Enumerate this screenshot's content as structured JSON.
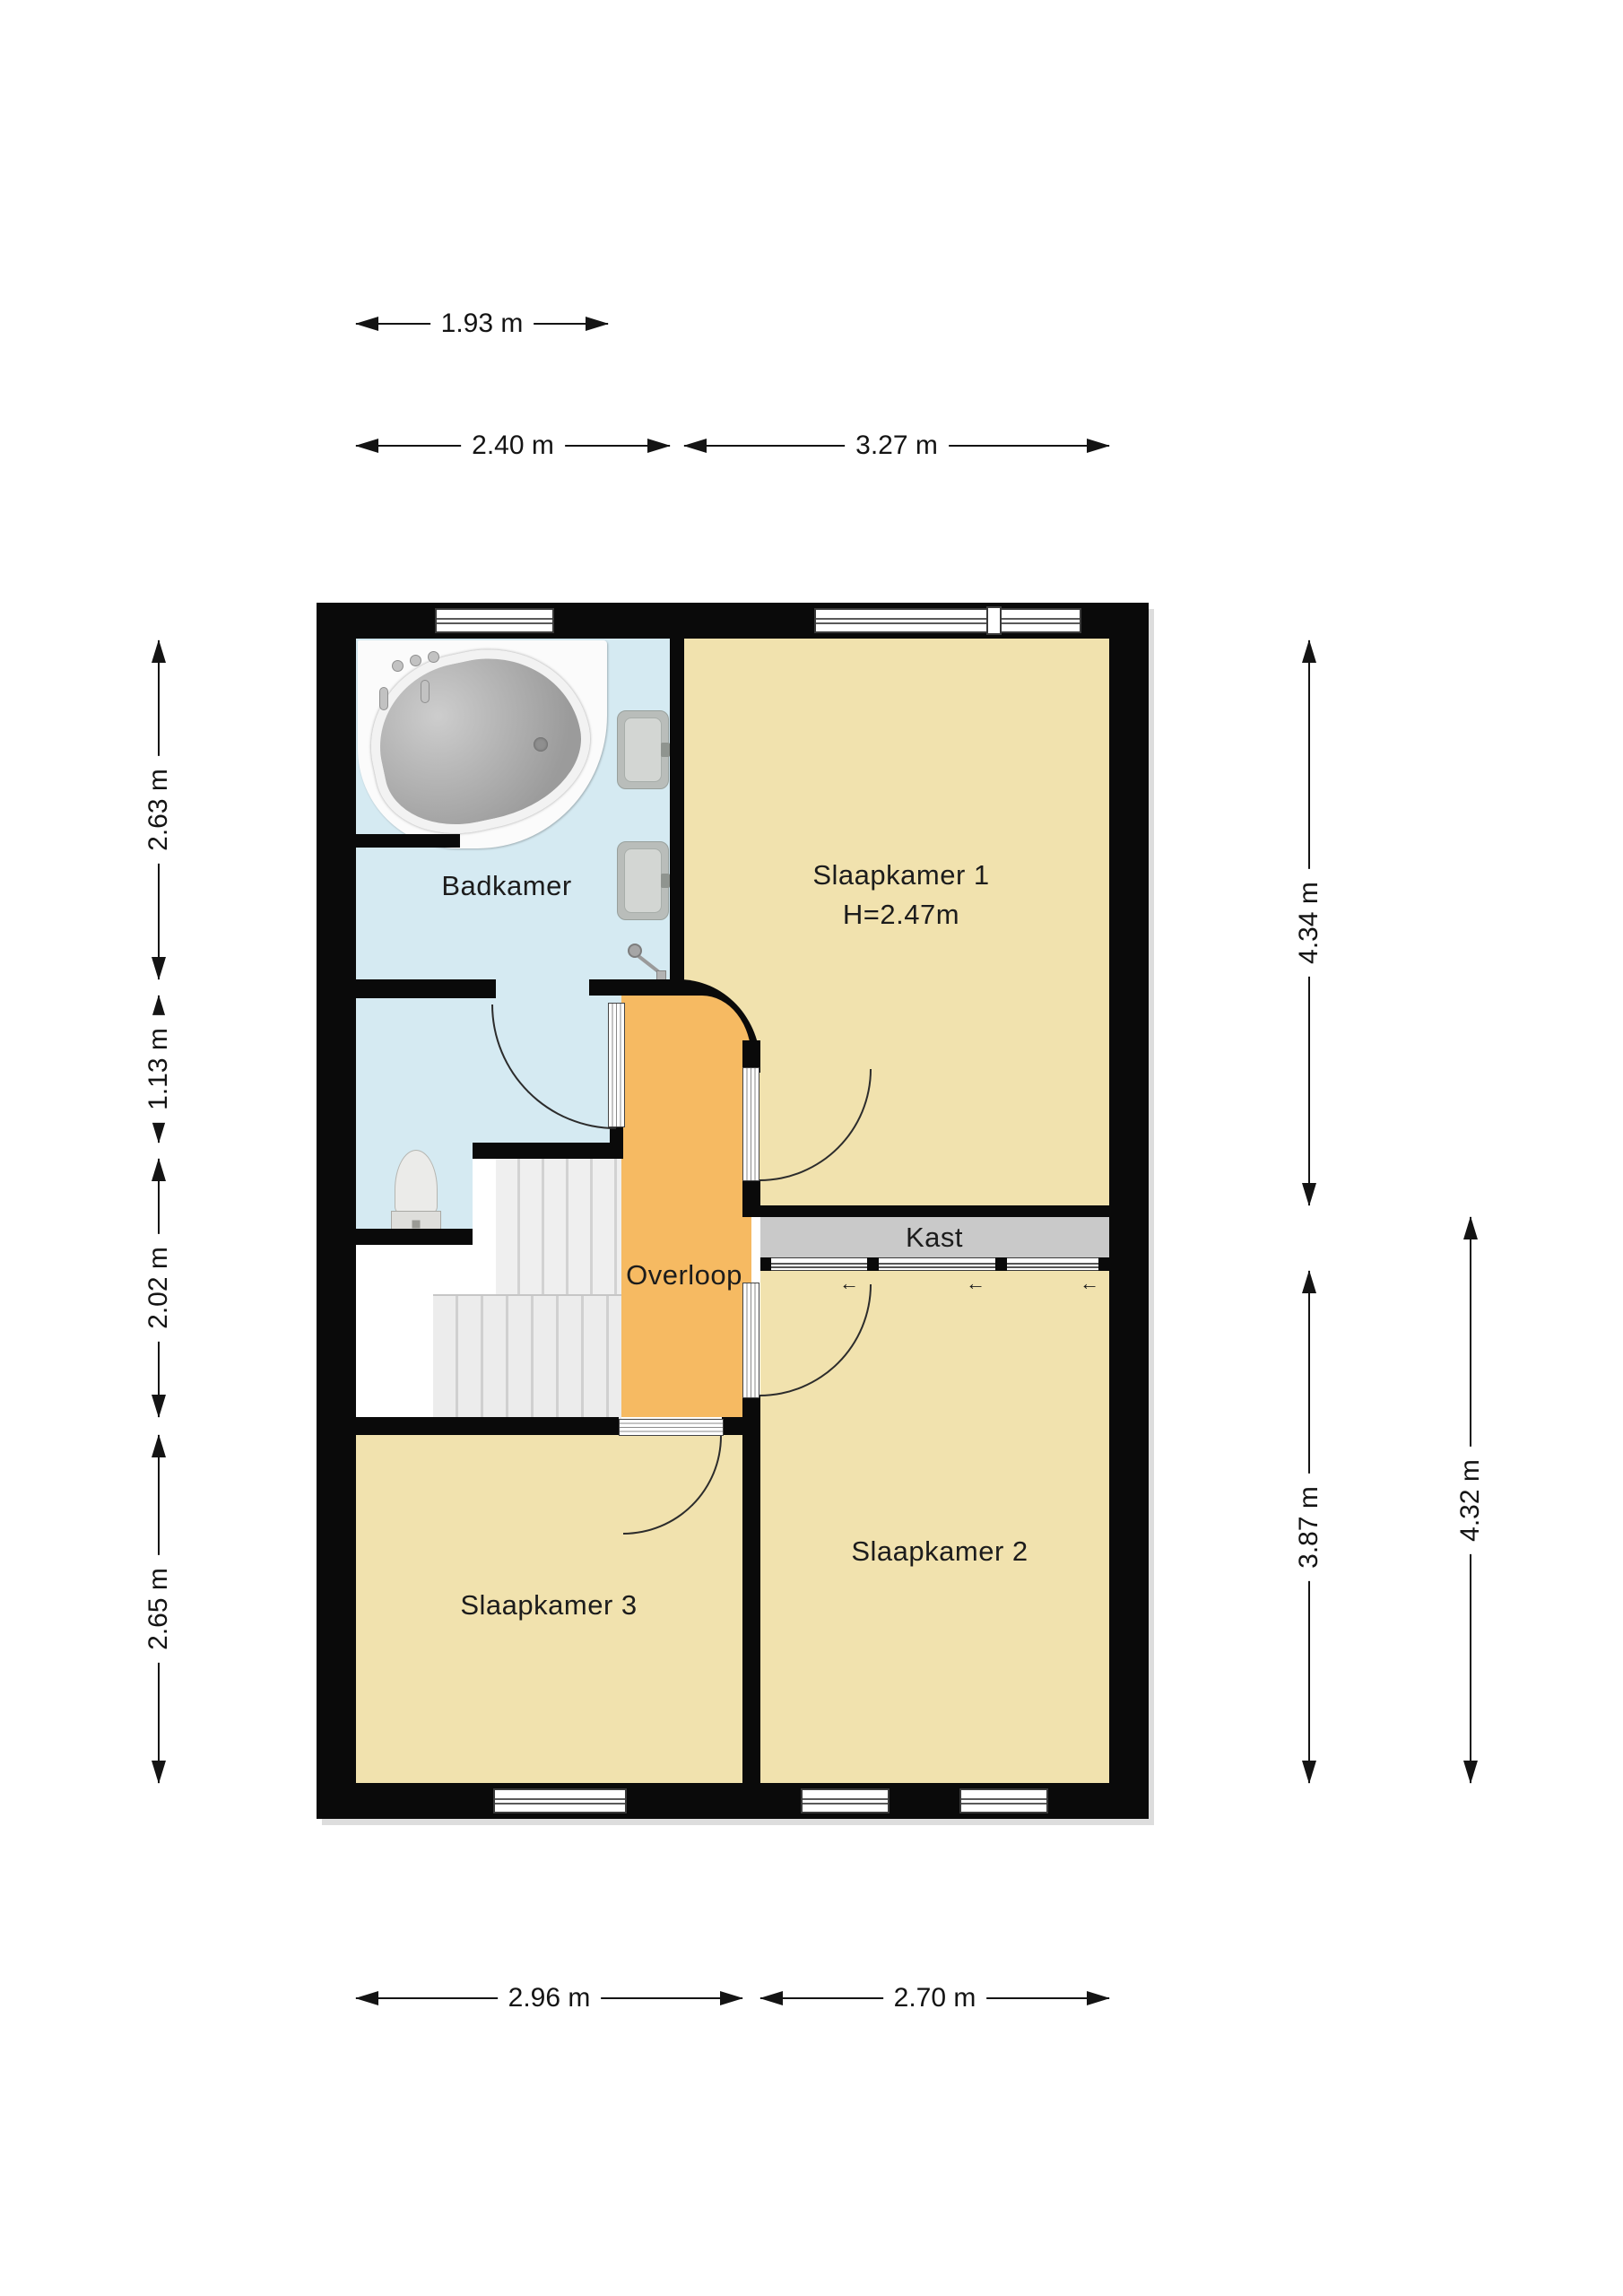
{
  "floorplan": {
    "type": "floor-plan",
    "rooms": {
      "badkamer": {
        "label": "Badkamer"
      },
      "slaapkamer1": {
        "label": "Slaapkamer 1",
        "ceiling_height": "H=2.47m"
      },
      "kast": {
        "label": "Kast"
      },
      "overloop": {
        "label": "Overloop"
      },
      "slaapkamer2": {
        "label": "Slaapkamer 2"
      },
      "slaapkamer3": {
        "label": "Slaapkamer 3"
      }
    },
    "dimensions": {
      "top": [
        "1.93 m",
        "2.40 m",
        "3.27 m"
      ],
      "bottom": [
        "2.96 m",
        "2.70 m"
      ],
      "left": [
        "2.63 m",
        "1.13 m",
        "2.02 m",
        "2.65 m"
      ],
      "right": [
        "4.34 m",
        "3.87 m",
        "4.32 m"
      ]
    },
    "icons": {
      "slide_left_arrow": "←"
    },
    "colors": {
      "wall": "#0a0a0a",
      "bathroom_floor": "#d5eaf2",
      "bedroom_floor": "#f1e2ae",
      "landing_floor": "#f6ba62",
      "closet_fill": "#c9c9c9",
      "dimension_ink": "#141414",
      "background": "#ffffff"
    }
  }
}
